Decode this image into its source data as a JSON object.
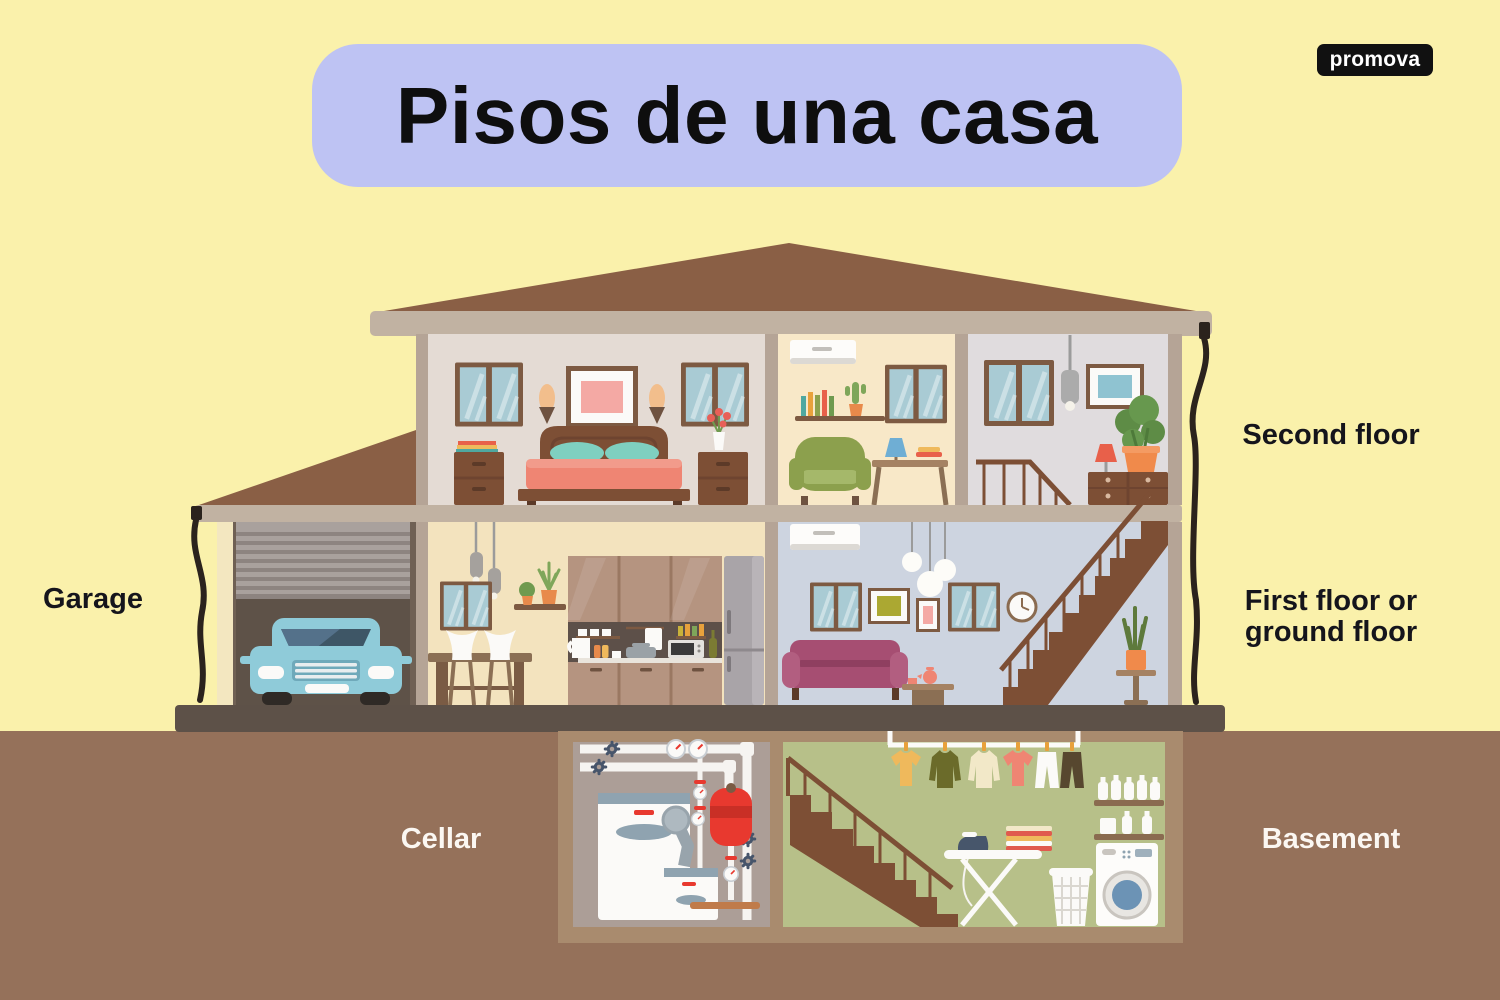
{
  "title": {
    "text": "Pisos de una casa"
  },
  "logo": {
    "text": "promova"
  },
  "labels": {
    "garage": "Garage",
    "second_floor": "Second floor",
    "first_floor_line1": "First floor or",
    "first_floor_line2": "ground floor",
    "cellar": "Cellar",
    "basement": "Basement"
  },
  "colors": {
    "background": "#FAF1AB",
    "underground": "#95715A",
    "title_pill": "#BEC3F3",
    "title_text": "#0E0E0E",
    "label_dark": "#15151C",
    "label_light": "#FBF7F2",
    "logo_bg": "#111111",
    "logo_text": "#FFFFFF",
    "roof": "#8A5F45",
    "house_frame": "#C1B2A2"
  }
}
